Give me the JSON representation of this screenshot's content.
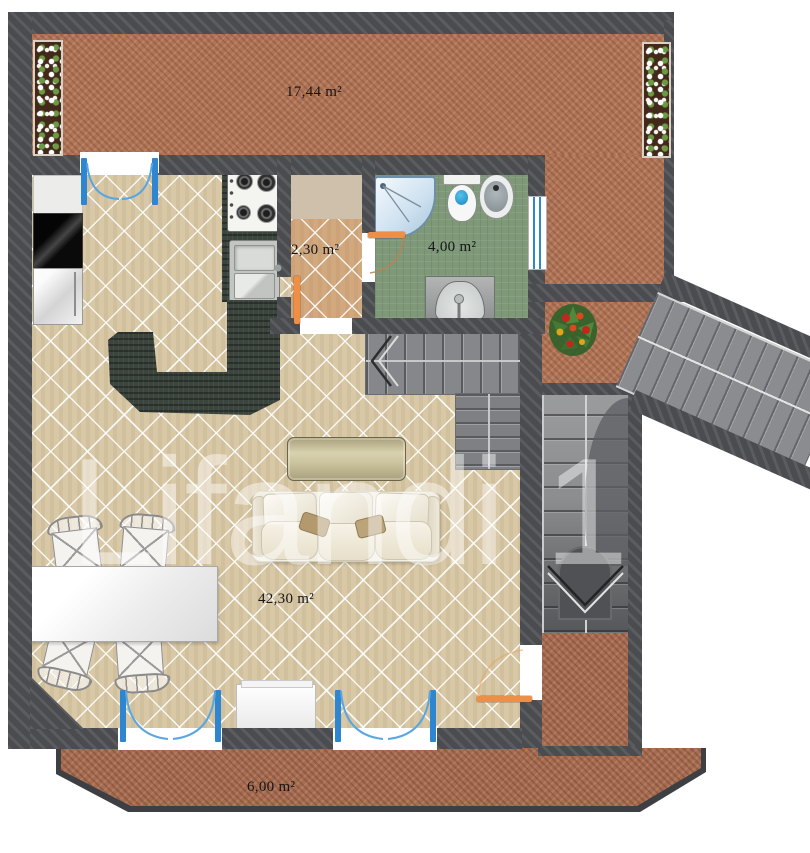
{
  "title": "Apartment floor plan",
  "watermark": {
    "text": "Lifandi 1"
  },
  "rooms": {
    "terrace": {
      "name": "terrace",
      "label": "17,44 m²"
    },
    "hallway": {
      "name": "hallway",
      "label": "2,30 m²"
    },
    "bathroom": {
      "name": "bathroom",
      "label": "4,00 m²"
    },
    "living_room": {
      "name": "living-room",
      "label": "42,30 m²"
    },
    "balcony": {
      "name": "balcony",
      "label": "6,00 m²"
    }
  },
  "colors": {
    "wall": "#4b4c50",
    "brick": "#b07457",
    "balcony_brick": "#a76d52",
    "floor": "#d8c8a6",
    "hall_floor": "#d2a87e",
    "bath_floor": "#7e9878",
    "counter_dark": "#3b443d",
    "door_blue": "#2e86d1",
    "door_orange": "#ef8f45",
    "stair_gray": "#85878a"
  }
}
